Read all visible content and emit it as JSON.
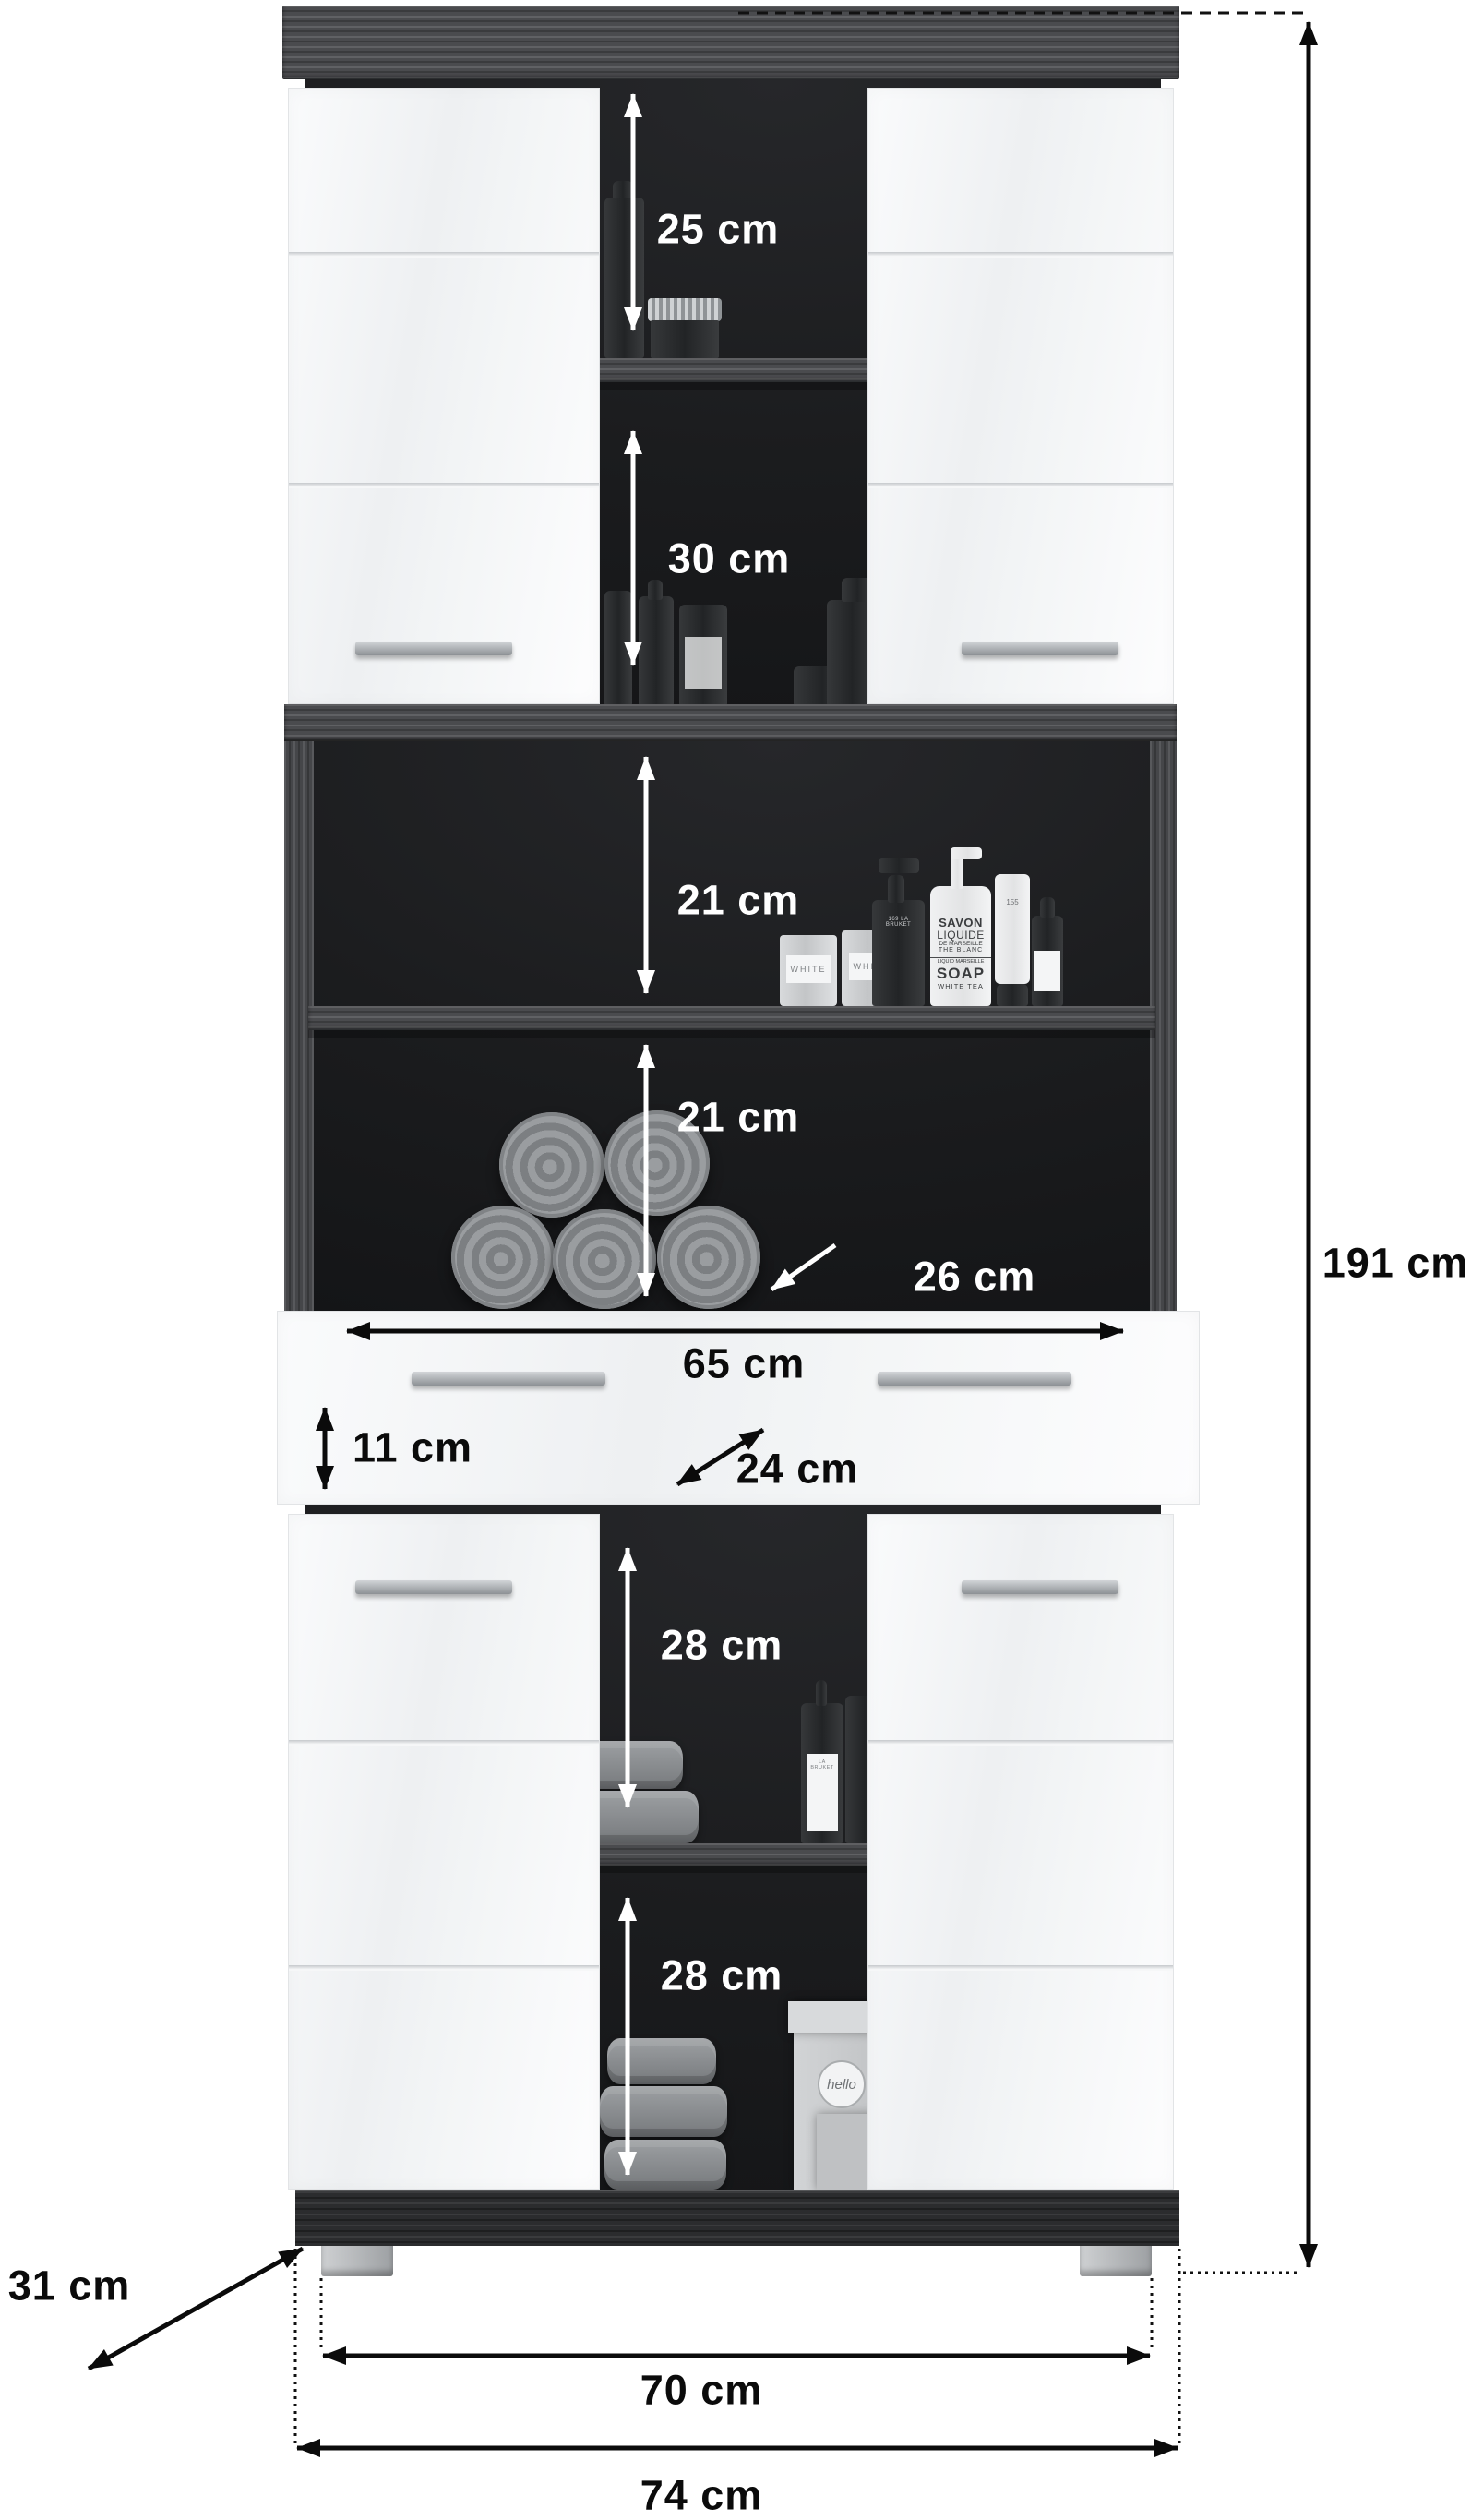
{
  "labels": {
    "c25": "25 cm",
    "c30": "30 cm",
    "c21a": "21 cm",
    "c21b": "21 cm",
    "c26": "26 cm",
    "c65": "65 cm",
    "c11": "11 cm",
    "c24": "24 cm",
    "c28a": "28 cm",
    "c28b": "28 cm",
    "c191": "191 cm",
    "c31": "31 cm",
    "c70": "70 cm",
    "c74": "74 cm"
  },
  "products": {
    "soap_l1": "SAVON",
    "soap_l2": "LIQUIDE",
    "soap_l3": "DE MARSEILLE",
    "soap_l4": "THE BLANC",
    "soap_l5": "LIQUID MARSEILLE",
    "soap_l6": "SOAP",
    "soap_l7": "WHITE TEA",
    "candle_label": "WHITE",
    "pump_label": "169 LA BRUKET",
    "tube_label": "155",
    "bruket_label": "LA BRUKET",
    "box_tag": "hello"
  },
  "colors": {
    "background": "#ffffff",
    "wood": "#4a4b4e",
    "plinth": "#2b2c2e",
    "interior": "#1b1c1e",
    "door": "#f2f3f4",
    "handle": "#a8acb0",
    "dimension_dark": "#0b0b0b",
    "dimension_light": "#ffffff"
  }
}
